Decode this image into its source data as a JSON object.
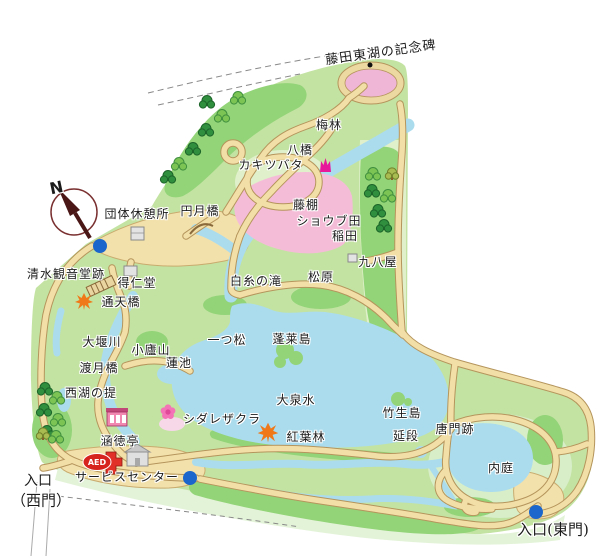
{
  "map": {
    "aed_label": "AED",
    "compass_label": "N",
    "colors": {
      "park_base": "#c3e3a2",
      "park_mid": "#93d478",
      "park_pale": "#dff0cb",
      "water": "#aadcee",
      "path_fill": "#f2dfa8",
      "path_edge": "#b5955c",
      "plaza_tan": "#f3e1ac",
      "shobu_pink": "#f5bcd8",
      "ume_oval_pink": "#efb6d6",
      "sakura_pale_pink": "#f6d8e8",
      "toilet_blue": "#1a66cc",
      "aed_red": "#d6231e",
      "building_gray": "#e3e3e3",
      "maple_orange": "#f07818",
      "blossom_pink": "#f472b6",
      "tulip_magenta": "#e8189a",
      "label_color": "#1b1b1b"
    },
    "labels": [
      {
        "name": "label-fujita-toko-monument",
        "text": "藤田東湖の記念碑",
        "x": 381,
        "y": 53,
        "size": 13,
        "rotate": -8
      },
      {
        "name": "label-ume-grove",
        "text": "梅林",
        "x": 329,
        "y": 125,
        "size": 12
      },
      {
        "name": "label-yatsuhashi",
        "text": "八橋",
        "x": 300,
        "y": 150,
        "size": 12
      },
      {
        "name": "label-kakitsubata",
        "text": "カキツバタ",
        "x": 271,
        "y": 165,
        "size": 12
      },
      {
        "name": "label-group-rest-area",
        "text": "団体休憩所",
        "x": 137,
        "y": 214,
        "size": 12
      },
      {
        "name": "label-engetsukyo-bridge",
        "text": "円月橋",
        "x": 200,
        "y": 211,
        "size": 12
      },
      {
        "name": "label-fujidana",
        "text": "藤棚",
        "x": 306,
        "y": 205,
        "size": 12
      },
      {
        "name": "label-shobu-field",
        "text": "ショウブ田",
        "x": 329,
        "y": 221,
        "size": 12
      },
      {
        "name": "label-inada",
        "text": "稲田",
        "x": 345,
        "y": 236,
        "size": 12
      },
      {
        "name": "label-kuhachiya",
        "text": "九八屋",
        "x": 378,
        "y": 262,
        "size": 12
      },
      {
        "name": "label-shimizu-kannondo-site",
        "text": "清水観音堂跡",
        "x": 66,
        "y": 274,
        "size": 12
      },
      {
        "name": "label-shiraito-falls",
        "text": "白糸の滝",
        "x": 256,
        "y": 281,
        "size": 12
      },
      {
        "name": "label-matsubara",
        "text": "松原",
        "x": 321,
        "y": 277,
        "size": 12
      },
      {
        "name": "label-tokujindo",
        "text": "得仁堂",
        "x": 137,
        "y": 283,
        "size": 12
      },
      {
        "name": "label-tsutenkyo-bridge",
        "text": "通天橋",
        "x": 121,
        "y": 302,
        "size": 12
      },
      {
        "name": "label-oigawa",
        "text": "大堰川",
        "x": 102,
        "y": 342,
        "size": 12
      },
      {
        "name": "label-shorozan",
        "text": "小廬山",
        "x": 151,
        "y": 350,
        "size": 12
      },
      {
        "name": "label-hitotsumatsu",
        "text": "一つ松",
        "x": 227,
        "y": 340,
        "size": 12
      },
      {
        "name": "label-horaijima",
        "text": "蓬莱島",
        "x": 292,
        "y": 339,
        "size": 12
      },
      {
        "name": "label-hasuike",
        "text": "蓮池",
        "x": 179,
        "y": 363,
        "size": 12
      },
      {
        "name": "label-togetsukyo-bridge",
        "text": "渡月橋",
        "x": 99,
        "y": 368,
        "size": 12
      },
      {
        "name": "label-seiko-no-tsutsumi",
        "text": "西湖の提",
        "x": 91,
        "y": 393,
        "size": 12
      },
      {
        "name": "label-daisensui",
        "text": "大泉水",
        "x": 296,
        "y": 400,
        "size": 12
      },
      {
        "name": "label-shidarezakura",
        "text": "シダレザクラ",
        "x": 222,
        "y": 419,
        "size": 12
      },
      {
        "name": "label-momiji-grove",
        "text": "紅葉林",
        "x": 306,
        "y": 437,
        "size": 12
      },
      {
        "name": "label-chikubushima",
        "text": "竹生島",
        "x": 402,
        "y": 413,
        "size": 12
      },
      {
        "name": "label-nobedan",
        "text": "延段",
        "x": 406,
        "y": 436,
        "size": 12
      },
      {
        "name": "label-karamon-site",
        "text": "唐門跡",
        "x": 455,
        "y": 429,
        "size": 12
      },
      {
        "name": "label-uchiniwa",
        "text": "内庭",
        "x": 501,
        "y": 468,
        "size": 12
      },
      {
        "name": "label-kantokutei",
        "text": "涵徳亭",
        "x": 120,
        "y": 441,
        "size": 12
      },
      {
        "name": "label-service-center",
        "text": "サービスセンター",
        "x": 127,
        "y": 477,
        "size": 12
      },
      {
        "name": "label-entrance-west-1",
        "text": "入口",
        "x": 38,
        "y": 481,
        "size": 14,
        "serif": true
      },
      {
        "name": "label-entrance-west-2",
        "text": "（西門）",
        "x": 41,
        "y": 501,
        "size": 15,
        "serif": true
      },
      {
        "name": "label-entrance-east",
        "text": "入口(東門)",
        "x": 553,
        "y": 530,
        "size": 15,
        "serif": true
      },
      {
        "name": "compass-n-label",
        "text": "N",
        "x": 57,
        "y": 188,
        "size": 16,
        "bold": true,
        "rotate": -12
      }
    ],
    "toilets": [
      {
        "x": 100,
        "y": 246
      },
      {
        "x": 190,
        "y": 478
      },
      {
        "x": 536,
        "y": 512
      }
    ],
    "monument_dot": {
      "x": 370,
      "y": 65
    },
    "trees": [
      [
        207,
        103,
        "d"
      ],
      [
        222,
        117,
        "l"
      ],
      [
        206,
        131,
        "d"
      ],
      [
        238,
        99,
        "l"
      ],
      [
        193,
        150,
        "d"
      ],
      [
        179,
        165,
        "l"
      ],
      [
        168,
        178,
        "d"
      ],
      [
        373,
        175,
        "l"
      ],
      [
        392,
        175,
        "o"
      ],
      [
        372,
        192,
        "d"
      ],
      [
        388,
        197,
        "l"
      ],
      [
        378,
        212,
        "d"
      ],
      [
        384,
        227,
        "d"
      ],
      [
        45,
        390,
        "d"
      ],
      [
        57,
        399,
        "l"
      ],
      [
        44,
        411,
        "d"
      ],
      [
        58,
        421,
        "l"
      ],
      [
        47,
        433,
        "d"
      ],
      [
        43,
        435,
        "o"
      ],
      [
        56,
        438,
        "l"
      ]
    ],
    "icon_legend": [
      {
        "name": "north-compass-icon"
      },
      {
        "name": "toilet-marker"
      },
      {
        "name": "monument-dot"
      },
      {
        "name": "maple-icon"
      },
      {
        "name": "cherry-blossom-icon"
      },
      {
        "name": "tulip-icon"
      },
      {
        "name": "bridge-hatch-icon"
      },
      {
        "name": "building-icon"
      },
      {
        "name": "teahouse-icon"
      },
      {
        "name": "aed-badge"
      }
    ]
  }
}
